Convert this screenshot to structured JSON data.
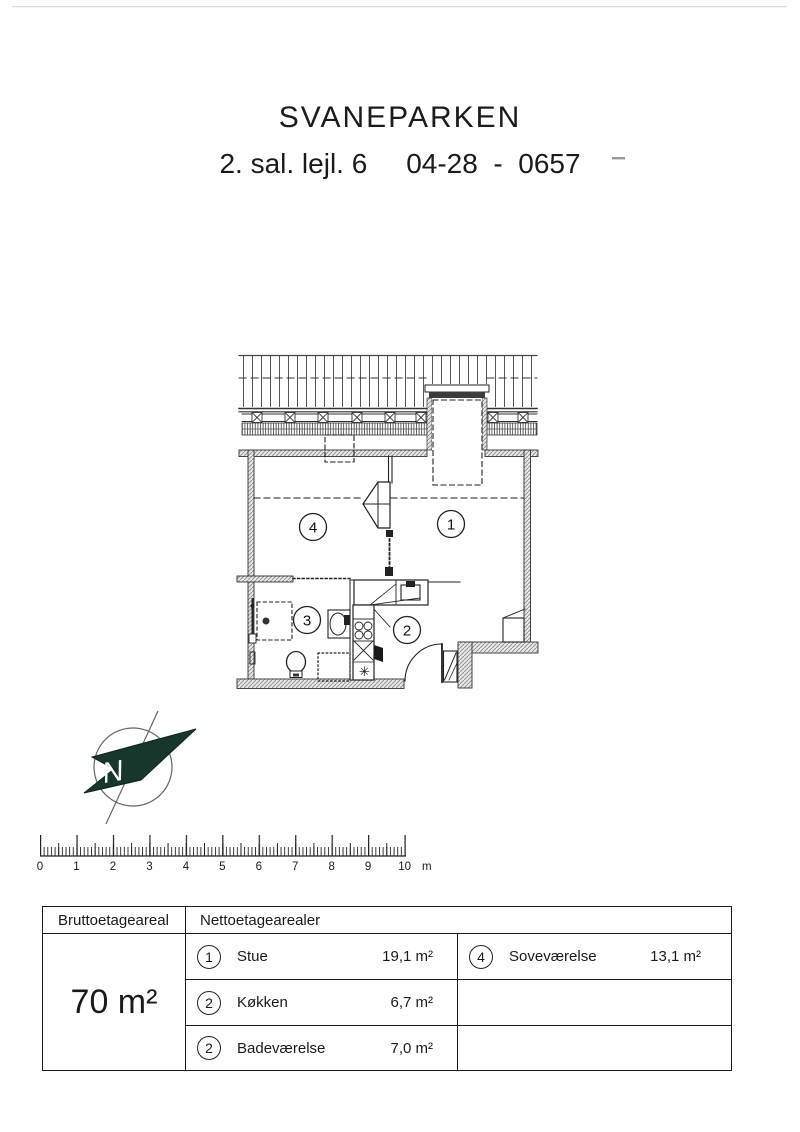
{
  "page": {
    "title": "SVANEPARKEN",
    "subtitle": "2. sal. lejl. 6     04-28  -  0657"
  },
  "plan": {
    "room_labels": {
      "stue": "1",
      "koekken": "2",
      "bad": "3",
      "sovevaerelse": "4"
    },
    "fridge_symbol": "✳"
  },
  "compass": {
    "label": "N"
  },
  "scale_bar": {
    "ticks": [
      "0",
      "1",
      "2",
      "3",
      "4",
      "5",
      "6",
      "7",
      "8",
      "9",
      "10"
    ],
    "unit": "m"
  },
  "area_table": {
    "gross_header": "Bruttoetageareal",
    "net_header": "Nettoetagearealer",
    "gross_area": "70 m²",
    "left_rows": [
      {
        "num": "1",
        "name": "Stue",
        "area": "19,1 m²"
      },
      {
        "num": "2",
        "name": "Køkken",
        "area": "6,7 m²"
      },
      {
        "num": "2",
        "name": "Badeværelse",
        "area": "7,0 m²"
      }
    ],
    "right_rows": [
      {
        "num": "4",
        "name": "Soveværelse",
        "area": "13,1 m²"
      }
    ]
  },
  "colors": {
    "ink": "#222222",
    "arrow_green": "#17362c"
  }
}
